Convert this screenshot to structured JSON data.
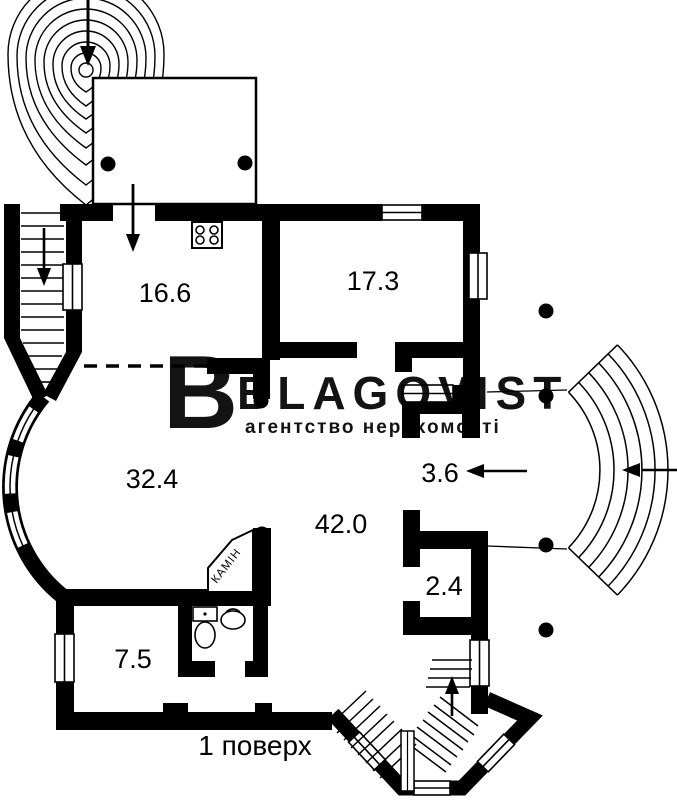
{
  "floor_label": "1 поверх",
  "watermark": {
    "logo_letter": "B",
    "brand": "BLAGOVIST",
    "tagline": "агентство нерухомості",
    "color": "#e0e0e0"
  },
  "rooms": [
    {
      "name": "kitchen",
      "area": "16.6"
    },
    {
      "name": "room-upper-right",
      "area": "17.3"
    },
    {
      "name": "living-room",
      "area": "32.4"
    },
    {
      "name": "hall",
      "area": "42.0"
    },
    {
      "name": "entry-corridor",
      "area": "3.6"
    },
    {
      "name": "closet",
      "area": "2.4"
    },
    {
      "name": "room-lower-left",
      "area": "7.5"
    }
  ],
  "fireplace": {
    "label": "КАМІН"
  },
  "colors": {
    "walls": "#000000",
    "background": "#ffffff",
    "watermark": "#e0e0e0"
  }
}
